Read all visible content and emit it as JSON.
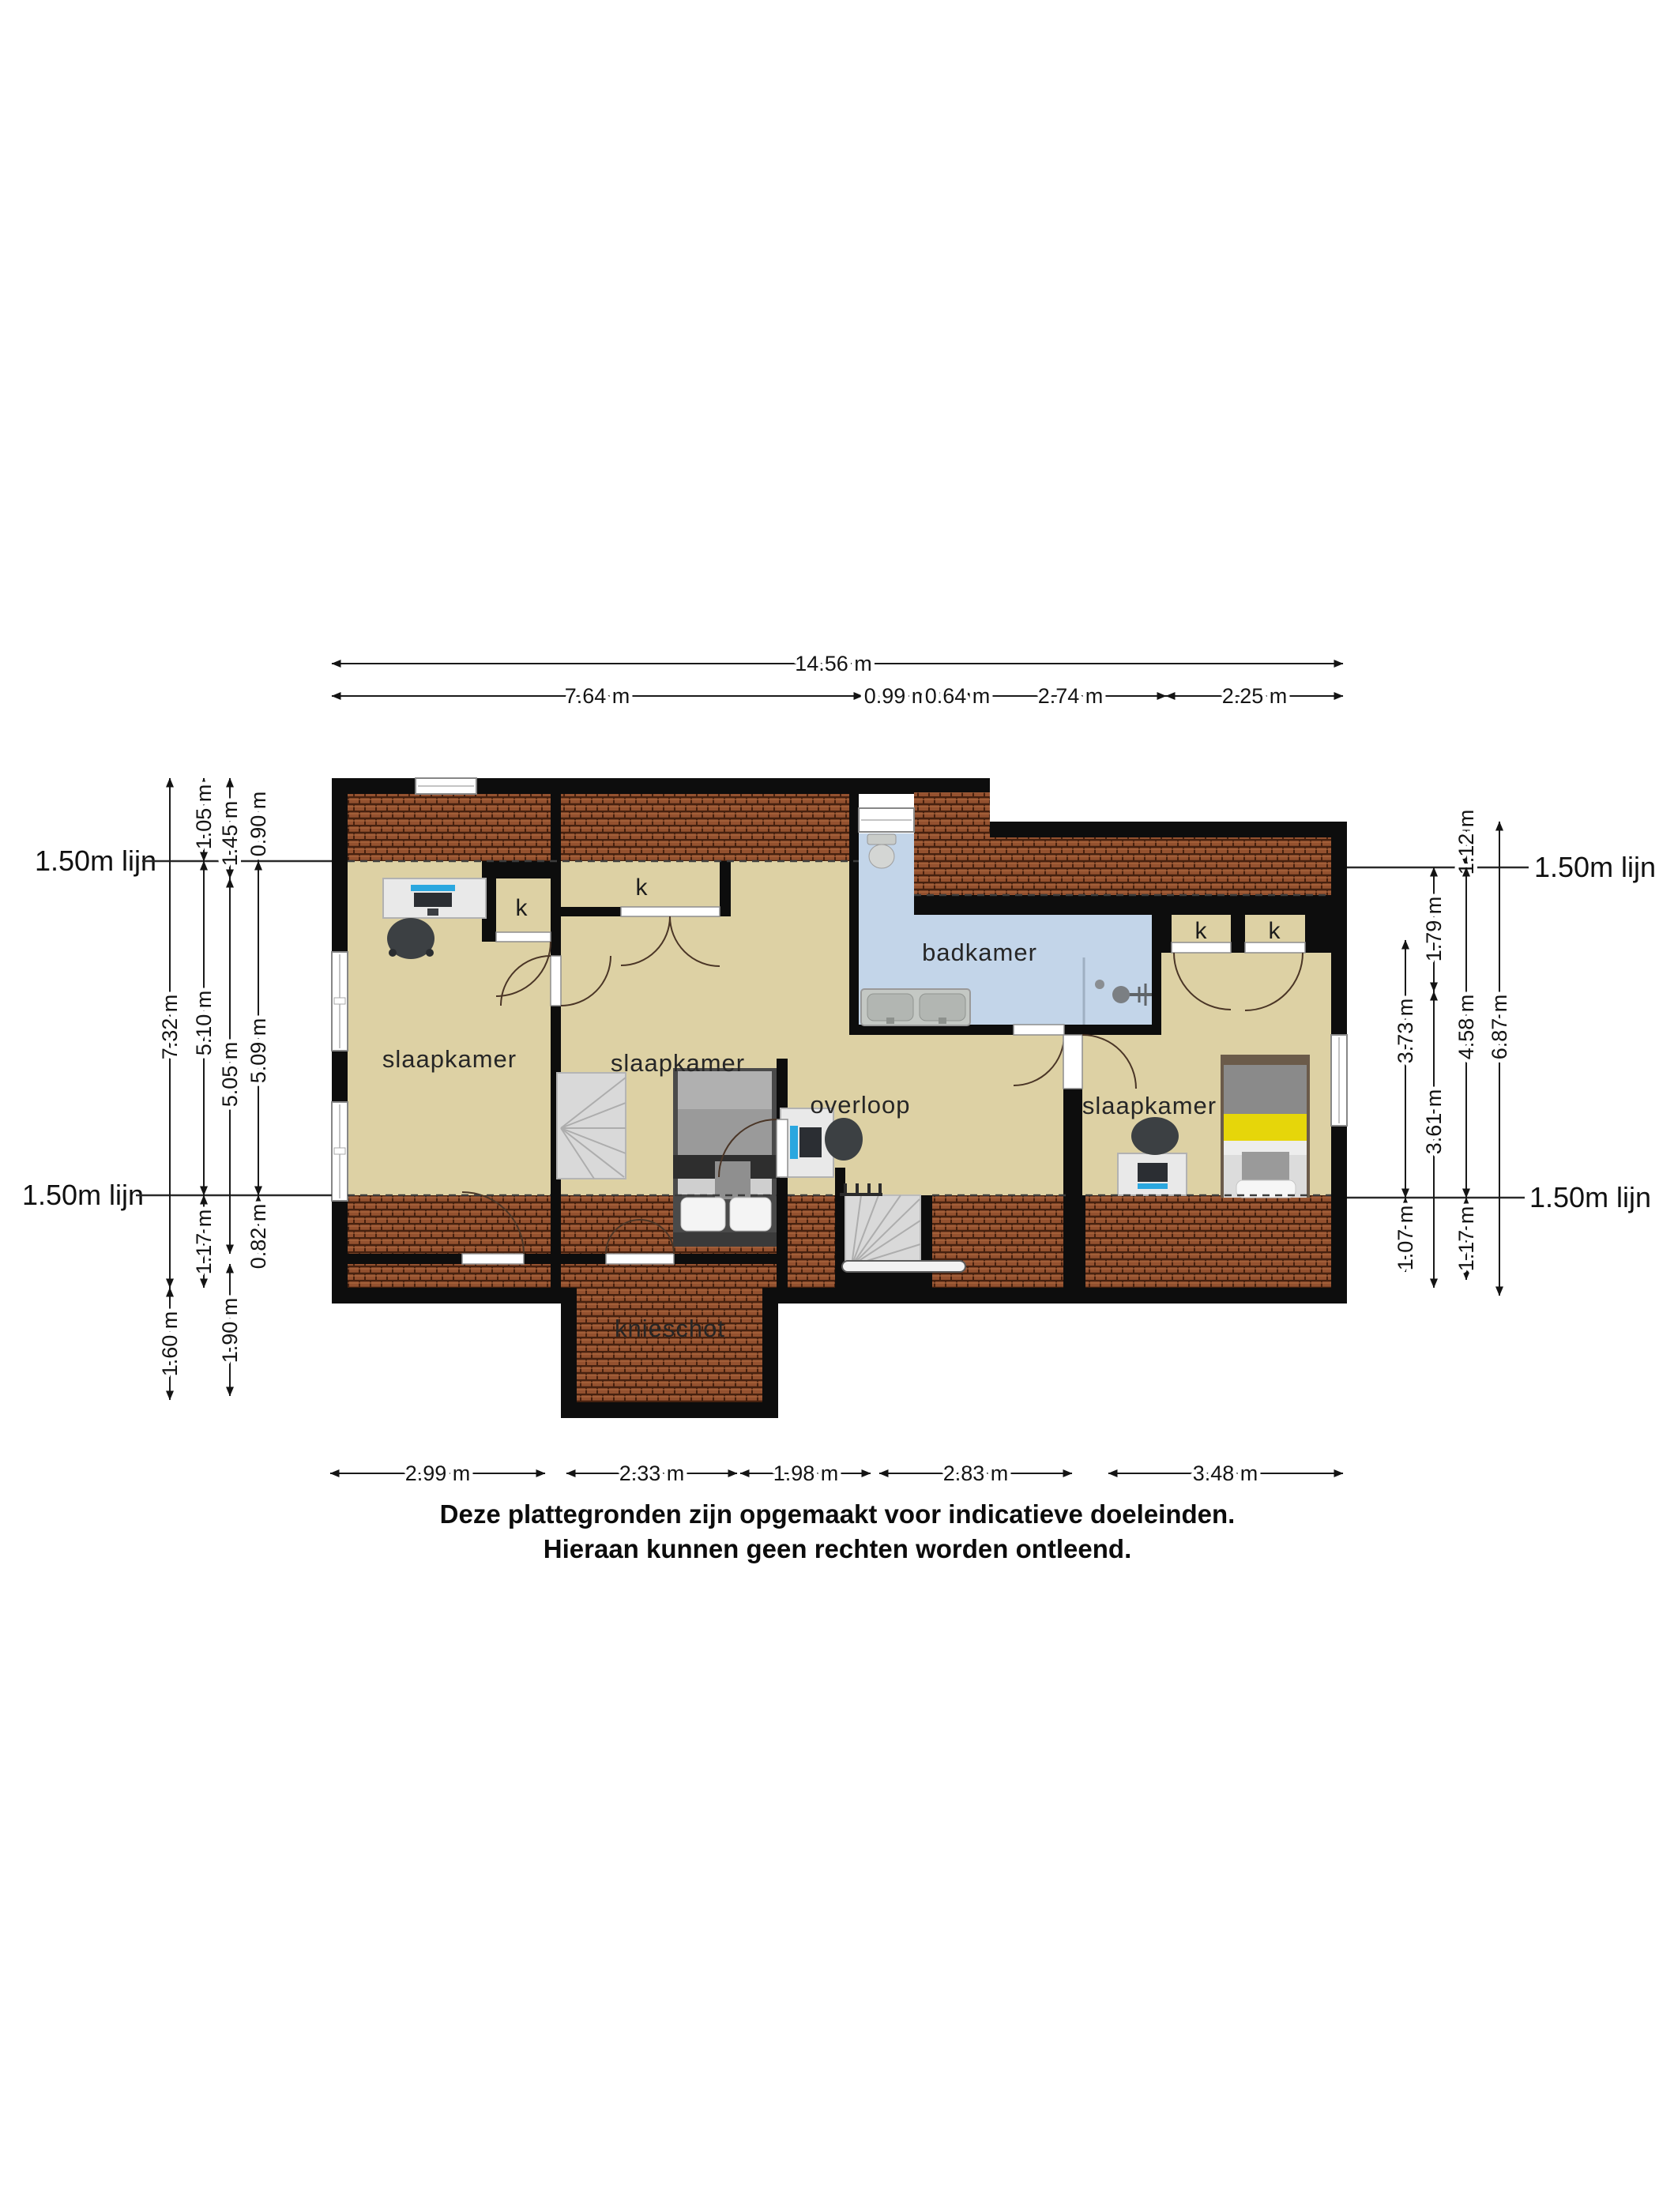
{
  "plan": {
    "room_labels": {
      "bedroom": "slaapkamer",
      "bathroom": "badkamer",
      "landing": "overloop",
      "knee_wall": "knieschot",
      "closet": "k"
    },
    "reference_line": "1.50m lijn",
    "dimensions": {
      "top": {
        "total": "14.56 m",
        "segments": [
          "7.64 m",
          "0.99 m",
          "0.64 m",
          "2.74 m",
          "2.25 m"
        ]
      },
      "bottom": {
        "segments": [
          "2.99 m",
          "2.33 m",
          "1.98 m",
          "2.83 m",
          "3.48 m"
        ]
      },
      "left": {
        "col1": [
          "7.32 m",
          "1.60 m"
        ],
        "col2": [
          "1.05 m",
          "5.10 m",
          "1.17 m"
        ],
        "col3": [
          "1.45 m",
          "5.05 m",
          "1.90 m"
        ],
        "col4": [
          "0.90 m",
          "5.09 m",
          "0.82 m"
        ]
      },
      "right": {
        "col1": [
          "3.73 m",
          "1.07 m"
        ],
        "col2": [
          "1.79 m",
          "3.61 m"
        ],
        "col3": [
          "1.12 m",
          "4.58 m",
          "1.17 m"
        ],
        "col4": [
          "6.87 m"
        ]
      }
    },
    "colors": {
      "wall": "#0d0d0d",
      "floor": "#ddd1a4",
      "bathroom_floor": "#c3d5e9",
      "roof_tiles": "#94512f",
      "bed_accent": "#e6d60a",
      "screen_accent": "#2ba7df"
    }
  },
  "footer": {
    "line1": "Deze plattegronden zijn opgemaakt voor indicatieve doeleinden.",
    "line2": "Hieraan kunnen geen rechten worden ontleend."
  }
}
